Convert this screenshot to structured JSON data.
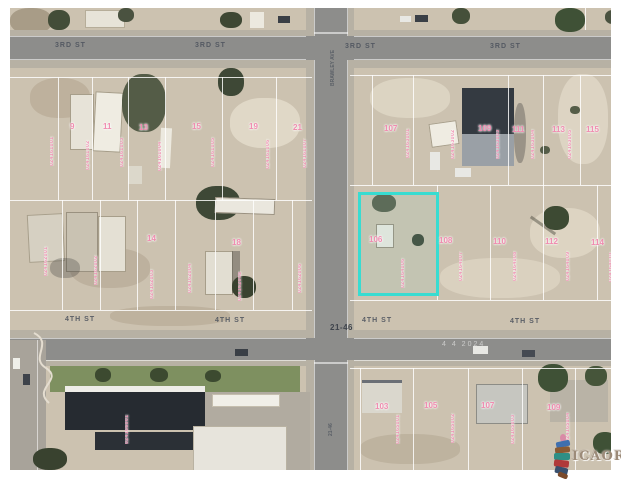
{
  "streets": {
    "third_street_labels": [
      {
        "text": "3RD ST",
        "x": 45,
        "y": 34
      },
      {
        "text": "3RD ST",
        "x": 185,
        "y": 34
      },
      {
        "text": "3RD ST",
        "x": 335,
        "y": 35
      },
      {
        "text": "3RD ST",
        "x": 480,
        "y": 35
      }
    ],
    "fourth_street_labels": [
      {
        "text": "4TH ST",
        "x": 55,
        "y": 308
      },
      {
        "text": "4TH ST",
        "x": 205,
        "y": 309
      },
      {
        "text": "4TH ST",
        "x": 352,
        "y": 309
      },
      {
        "text": "4TH ST",
        "x": 500,
        "y": 310
      }
    ],
    "vertical_labels": [
      {
        "text": "BRAWLEY AVE",
        "x": 320,
        "y": 30,
        "h": 48
      },
      {
        "text": "21-46",
        "x": 318,
        "y": 394,
        "h": 34
      }
    ],
    "block_marker": "21-46",
    "watermark": "4 4 2024"
  },
  "parcels": {
    "subject_lot": "106",
    "lot_numbers": [
      {
        "t": "9",
        "x": 60,
        "y": 114
      },
      {
        "t": "11",
        "x": 93,
        "y": 114
      },
      {
        "t": "13",
        "x": 129,
        "y": 115
      },
      {
        "t": "15",
        "x": 182,
        "y": 114
      },
      {
        "t": "19",
        "x": 239,
        "y": 114
      },
      {
        "t": "21",
        "x": 283,
        "y": 115
      },
      {
        "t": "14",
        "x": 137,
        "y": 226
      },
      {
        "t": "18",
        "x": 222,
        "y": 230
      },
      {
        "t": "107",
        "x": 374,
        "y": 116
      },
      {
        "t": "109",
        "x": 468,
        "y": 116
      },
      {
        "t": "111",
        "x": 502,
        "y": 117
      },
      {
        "t": "113",
        "x": 542,
        "y": 117
      },
      {
        "t": "115",
        "x": 576,
        "y": 117
      },
      {
        "t": "106",
        "x": 359,
        "y": 227
      },
      {
        "t": "108",
        "x": 429,
        "y": 228
      },
      {
        "t": "110",
        "x": 483,
        "y": 229
      },
      {
        "t": "112",
        "x": 535,
        "y": 229
      },
      {
        "t": "114",
        "x": 581,
        "y": 230
      },
      {
        "t": "103",
        "x": 365,
        "y": 394
      },
      {
        "t": "105",
        "x": 414,
        "y": 393
      },
      {
        "t": "107",
        "x": 471,
        "y": 393
      },
      {
        "t": "109",
        "x": 537,
        "y": 395
      }
    ],
    "apn_strips": [
      {
        "t": "024161001",
        "x": 40,
        "y": 100,
        "h": 58
      },
      {
        "t": "024161002",
        "x": 76,
        "y": 104,
        "h": 58
      },
      {
        "t": "024161003",
        "x": 110,
        "y": 99,
        "h": 60
      },
      {
        "t": "024161004",
        "x": 148,
        "y": 103,
        "h": 60
      },
      {
        "t": "024161005",
        "x": 201,
        "y": 101,
        "h": 58
      },
      {
        "t": "024161006",
        "x": 256,
        "y": 103,
        "h": 58
      },
      {
        "t": "024161007",
        "x": 293,
        "y": 100,
        "h": 60
      },
      {
        "t": "024162001",
        "x": 34,
        "y": 212,
        "h": 56
      },
      {
        "t": "024162002",
        "x": 84,
        "y": 219,
        "h": 58
      },
      {
        "t": "024162003",
        "x": 140,
        "y": 231,
        "h": 60
      },
      {
        "t": "024162004",
        "x": 178,
        "y": 227,
        "h": 58
      },
      {
        "t": "024162005",
        "x": 228,
        "y": 235,
        "h": 58
      },
      {
        "t": "024162006",
        "x": 288,
        "y": 229,
        "h": 56
      },
      {
        "t": "024163001",
        "x": 396,
        "y": 106,
        "h": 44
      },
      {
        "t": "024163002",
        "x": 441,
        "y": 109,
        "h": 42
      },
      {
        "t": "024163003",
        "x": 486,
        "y": 111,
        "h": 40
      },
      {
        "t": "024163004",
        "x": 521,
        "y": 109,
        "h": 42
      },
      {
        "t": "024163005",
        "x": 558,
        "y": 111,
        "h": 40
      },
      {
        "t": "024164006",
        "x": 391,
        "y": 214,
        "h": 66
      },
      {
        "t": "024164007",
        "x": 449,
        "y": 221,
        "h": 52
      },
      {
        "t": "024164008",
        "x": 503,
        "y": 223,
        "h": 50
      },
      {
        "t": "024164009",
        "x": 556,
        "y": 223,
        "h": 50
      },
      {
        "t": "024164010",
        "x": 599,
        "y": 224,
        "h": 50
      },
      {
        "t": "024165001",
        "x": 386,
        "y": 390,
        "h": 46
      },
      {
        "t": "024165002",
        "x": 441,
        "y": 387,
        "h": 48
      },
      {
        "t": "024165003",
        "x": 501,
        "y": 390,
        "h": 46
      },
      {
        "t": "024165004",
        "x": 556,
        "y": 388,
        "h": 46
      },
      {
        "t": "024166001",
        "x": 115,
        "y": 388,
        "h": 48
      }
    ]
  },
  "logo": {
    "text": "ICAOR"
  },
  "colors": {
    "highlight": "#38dcd1",
    "label_pink": "#f08cb0",
    "street_label": "#4e545e"
  }
}
